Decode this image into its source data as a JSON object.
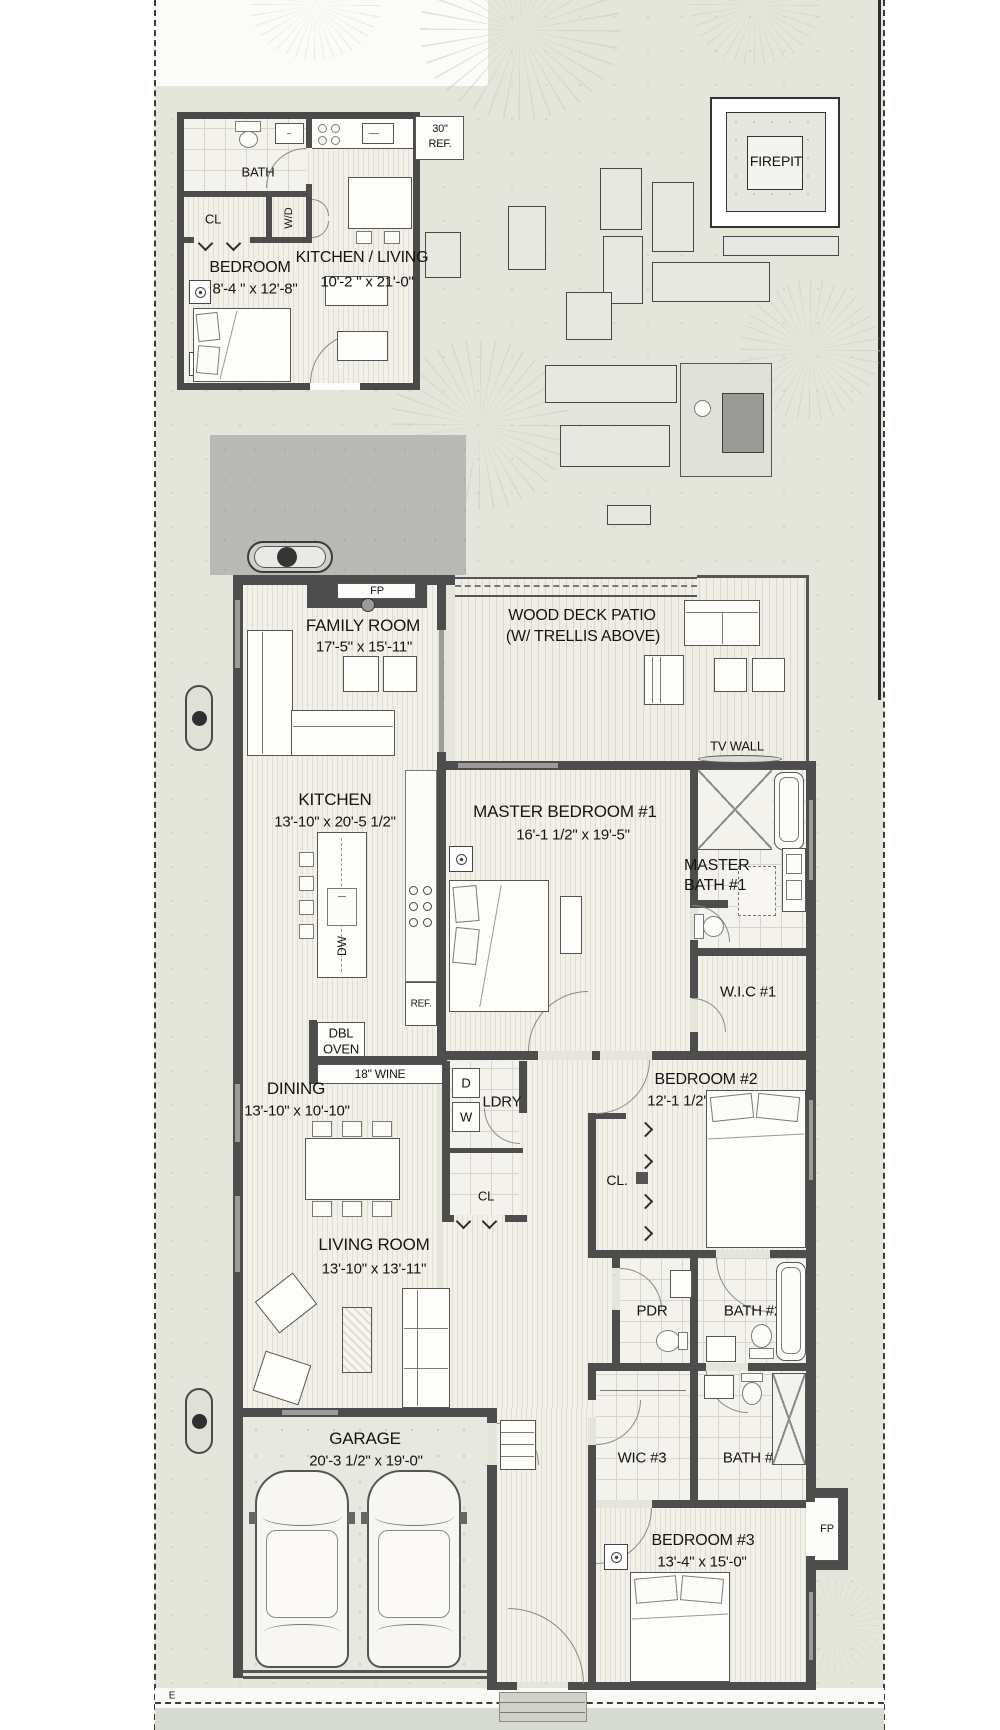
{
  "site": {
    "firepit": "FIREPIT",
    "marker": "E"
  },
  "adu": {
    "bath": "BATH",
    "closet": "CL",
    "washer_dryer": "W/D",
    "bedroom": "BEDROOM",
    "bedroom_dims": "8'-4 \" x 12'-8\"",
    "kitchen_living": "KITCHEN / LIVING",
    "kitchen_living_dims": "10'-2 \" x 21'-0\"",
    "ref_line1": "30\"",
    "ref_line2": "REF."
  },
  "outdoor": {
    "deck_line1": "WOOD DECK PATIO",
    "deck_line2": "(W/ TRELLIS ABOVE)",
    "tv_wall": "TV WALL"
  },
  "house": {
    "fp_family": "FP",
    "family_room": "FAMILY ROOM",
    "family_room_dims": "17'-5\" x 15'-11\"",
    "kitchen": "KITCHEN",
    "kitchen_dims": "13'-10\" x 20'-5 1/2\"",
    "dishwasher": "DW",
    "fridge": "REF.",
    "dbl_oven_line1": "DBL",
    "dbl_oven_line2": "OVEN",
    "wine": "18\" WINE",
    "master_bedroom": "MASTER BEDROOM #1",
    "master_bedroom_dims": "16'-1 1/2\" x 19'-5\"",
    "master_bath_line1": "MASTER",
    "master_bath_line2": "BATH #1",
    "wic1": "W.I.C #1",
    "dining": "DINING",
    "dining_dims": "13'-10\" x 10'-10\"",
    "dryer": "D",
    "washer": "W",
    "laundry": "LDRY",
    "closet_hall": "CL",
    "closet_bed2": "CL.",
    "bedroom2": "BEDROOM #2",
    "bedroom2_dims": "12'-1 1/2\" x 13'-0\"",
    "living_room": "LIVING ROOM",
    "living_room_dims": "13'-10\" x 13'-11\"",
    "powder": "PDR",
    "bath2": "BATH #2",
    "garage": "GARAGE",
    "garage_dims": "20'-3 1/2\" x 19'-0\"",
    "wic3": "WIC #3",
    "bath3": "BATH #3",
    "bedroom3": "BEDROOM #3",
    "bedroom3_dims": "13'-4\" x 15'-0\"",
    "fp_bed3": "FP"
  }
}
